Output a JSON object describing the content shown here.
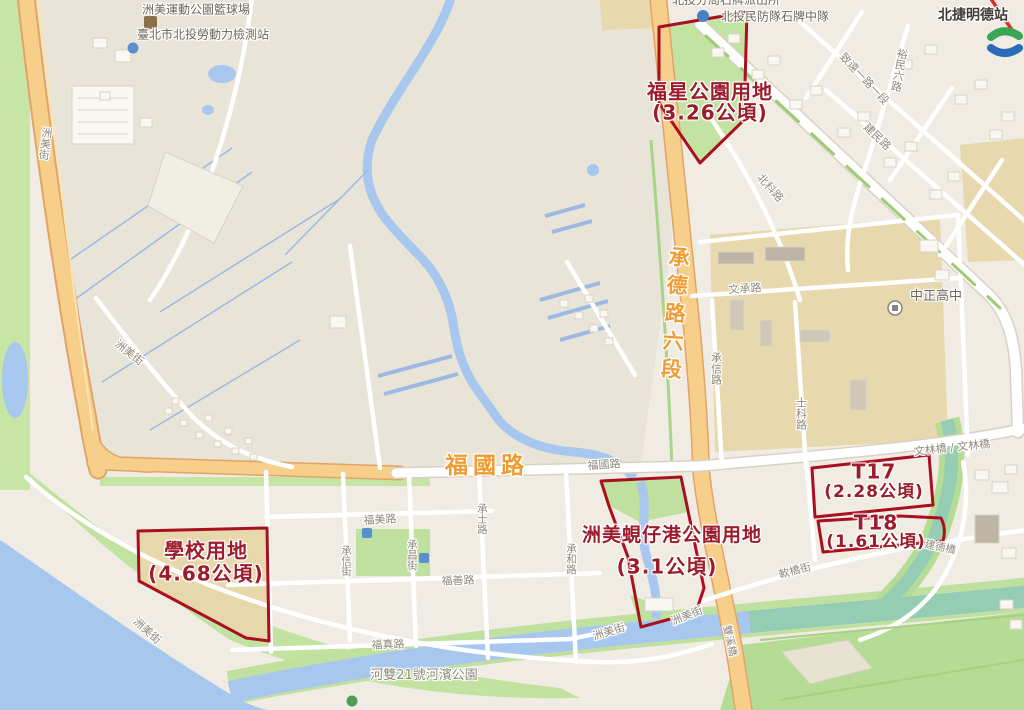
{
  "colors": {
    "land": "#f0ece3",
    "land_west": "#e9e4d8",
    "water": "#a7c7ef",
    "water_teal": "#94cdb4",
    "green": "#c7e5a4",
    "green_dark": "#b5dc95",
    "campus": "#e7d8ae",
    "road_major_fill": "#f7cf8b",
    "road_major_edge": "#e2a368",
    "parcel_outline": "#a90f1f",
    "parcel_text": "#9b1c2c",
    "road_label_orange": "#ef9d33",
    "street_label_gray": "#8f897c",
    "mrt_red": "#d93025"
  },
  "parcels": {
    "fuxing_park": {
      "name": "福星公園用地",
      "area": "(3.26公頃)"
    },
    "school": {
      "name": "學校用地",
      "area": "(4.68公頃)"
    },
    "shellport_park": {
      "name": "洲美蜆仔港公園用地",
      "area": "(3.1公頃)"
    },
    "t17": {
      "name": "T17",
      "area": "(2.28公頃)"
    },
    "t18": {
      "name": "T18",
      "area": "(1.61公頃)"
    }
  },
  "major_roads": {
    "chengde": "承德路六段",
    "fuguo": "福國路",
    "fuguo_small": "福國路"
  },
  "streets": {
    "zhoumei_hwy": "洲美街",
    "zhoumei_mid": "洲美街",
    "zhoumei_sw": "洲美街",
    "zhoumei_s1": "洲美街",
    "zhoumei_s2": "洲美街",
    "wencheng": "文承路",
    "chengxin_rd": "承信路",
    "shike": "士科路",
    "beike": "北科路",
    "zhiyuan": "致遠一路一段",
    "jianmin": "建民路",
    "yumin": "裕民六路",
    "fumei": "福美路",
    "fushan": "福善路",
    "fuzhen": "福真路",
    "chengxin_st": "承信街",
    "chengchang_st": "承昌街",
    "chengshi_st": "承士路",
    "chenghe_rd": "承和路",
    "ruanqiao": "軟橋街"
  },
  "bridges": {
    "wenlin": "文林橋 / 文林橋",
    "jiande": "建德橋",
    "shuangxi": "雙溪橋"
  },
  "pois": {
    "basketball": "洲美運動公園籃球場",
    "labor_station": "臺北市北投勞動力檢測站",
    "police": "北投分局石牌派出所",
    "civil_defense": "北投民防隊石牌中隊",
    "mrt_station": "北捷明德站",
    "highschool": "中正高中",
    "riverside_park": "河雙21號河濱公園"
  }
}
